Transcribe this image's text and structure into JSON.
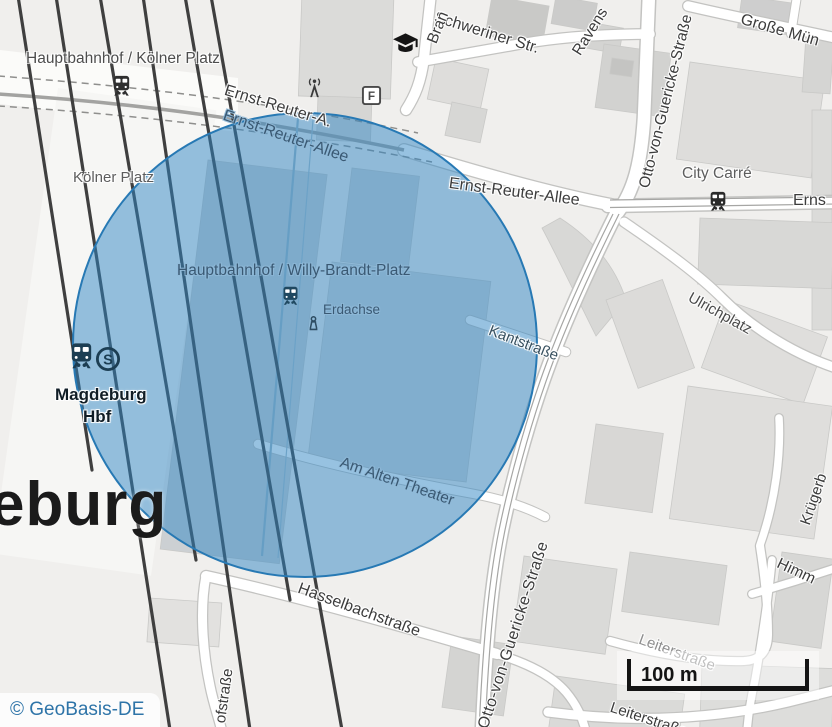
{
  "colors": {
    "circle_fill": "#2f86c4",
    "circle_stroke": "#2779b4",
    "railway": "#3f3f3f",
    "attribution_link": "#2e74a8",
    "scale_bar": "#141414"
  },
  "attribution": {
    "text": "© GeoBasis-DE"
  },
  "scale": {
    "label": "100 m"
  },
  "city": {
    "name_partial": "eburg"
  },
  "poi": {
    "station_koelner": "Hauptbahnhof / Kölner Platz",
    "koelner_platz": "Kölner Platz",
    "station_willy": "Hauptbahnhof / Willy-Brandt-Platz",
    "erdachse": "Erdachse",
    "magdeburg_hbf_line1": "Magdeburg",
    "magdeburg_hbf_line2": "Hbf",
    "city_carre": "City Carré",
    "ulrichplatz": "Ulrichplatz",
    "f_marker": "F",
    "sbahn_letter": "S"
  },
  "streets": {
    "ernst_reuter_a": "Ernst-Reuter-A.",
    "ernst_reuter_allee_tunnel": "Ernst-Reuter-Allee",
    "ernst_reuter_allee_east": "Ernst-Reuter-Allee",
    "ernst_reuter_allee_edge": "Erns",
    "schweriner_str": "Schweriner Str.",
    "brandenburger_partial": "Bran",
    "ravensberger_partial": "Ravens",
    "grosse_muenz_partial": "Große Mün",
    "otto_von_guericke_north": "Otto-von-Guericke-Straße",
    "otto_von_guericke_south": "Otto-von-Guericke-Straße",
    "kantstrasse": "Kantstraße",
    "am_alten_theater": "Am Alten Theater",
    "hasselbachstrasse": "Hasselbachstraße",
    "bahnhofstrasse_partial": "ofstraße",
    "leiterstrasse_1": "Leiterstraße",
    "leiterstrasse_2": "Leiterstraße",
    "kruegerbruecke_partial": "Krügerb",
    "himmelreich_partial": "Himm"
  }
}
